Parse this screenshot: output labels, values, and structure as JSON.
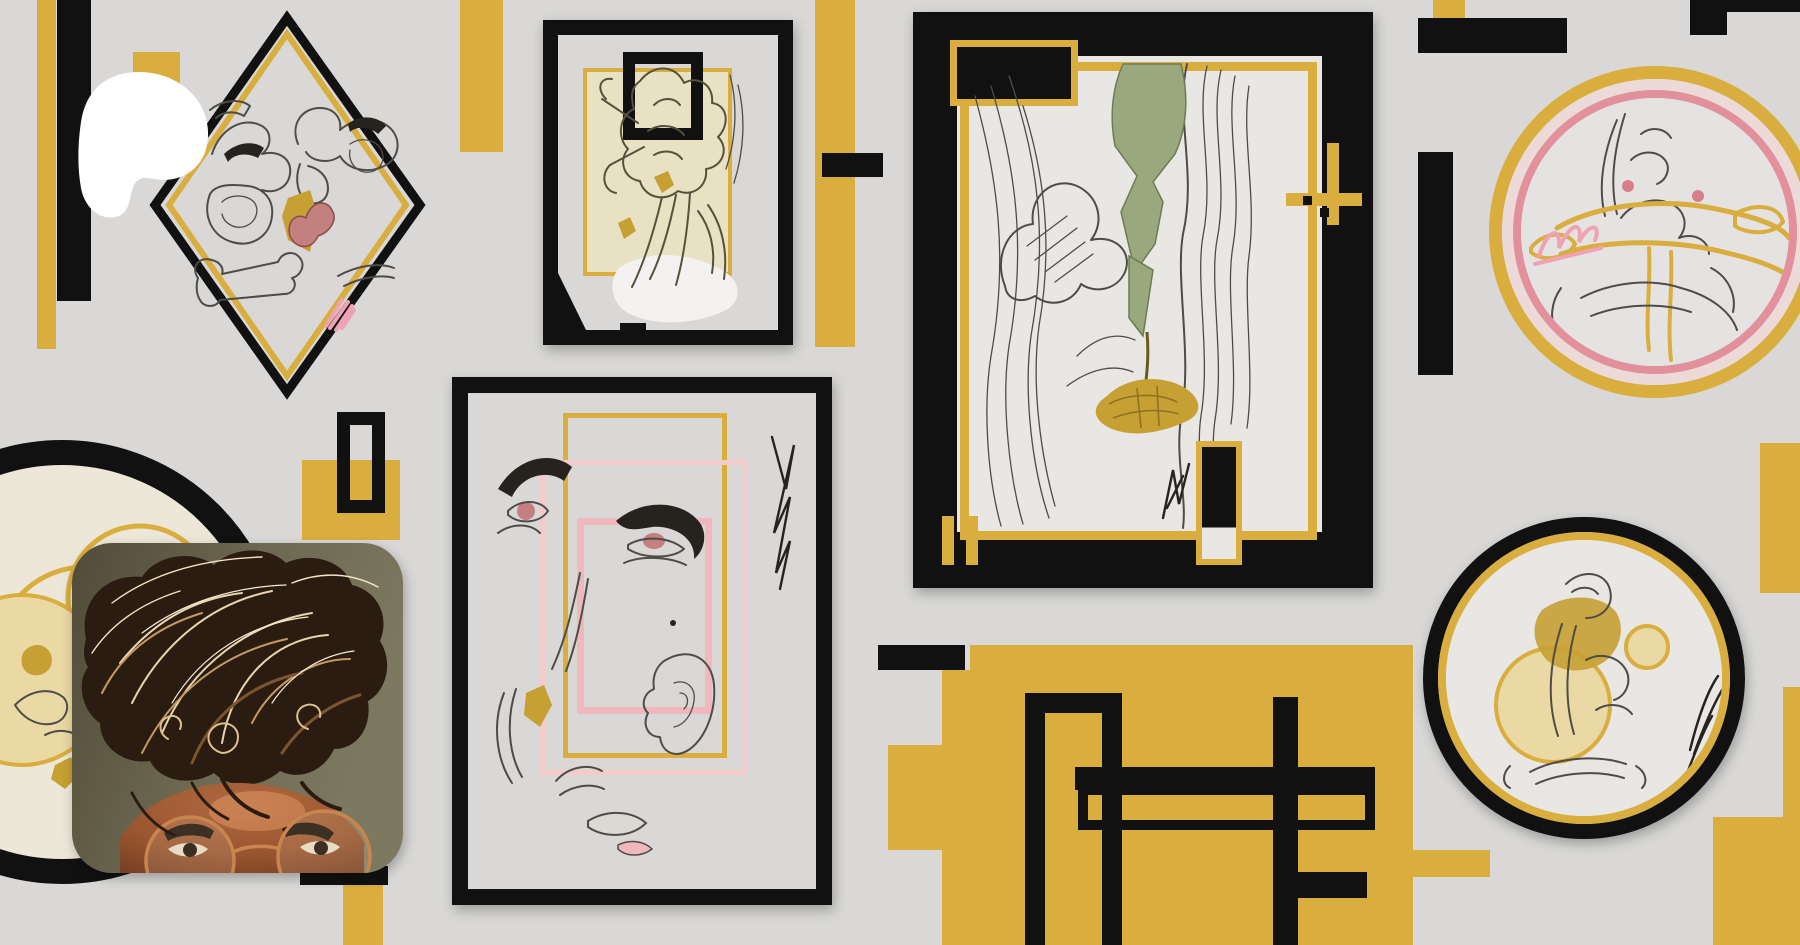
{
  "page": {
    "site": "Patreon",
    "view": "creator-page-header",
    "visible_text": []
  },
  "header": {
    "logo": {
      "name": "patreon-logo",
      "shape": "white-blob",
      "color": "#ffffff"
    },
    "avatar": {
      "shape": "rounded-square",
      "alt": "selfie of a person with sunlit curly brown hair and round wire glasses",
      "corner_radius_px": 40
    },
    "banner": {
      "alt": "abstract collage banner: framed pencil sketches with black and gold geometric blocks on gray"
    }
  },
  "palette": {
    "bg": "#d9d8d6",
    "yellow": "#d9ae3e",
    "black": "#111111",
    "cream": "#ece7d8",
    "beige": "#e8e1c4",
    "sage": "#9aa87e",
    "gold": "#c6a033",
    "lip": "#c47f7f",
    "ink": "#4e4c48",
    "inkDark": "#26231f",
    "white": "#ffffff",
    "pinkRingLight": "#ecdad8",
    "pinkRing": "#e2909b",
    "pinkRectLight": "#f3cbca",
    "pinkRect": "#f0b7bc",
    "pinkSig": "#efa2b2",
    "interiorC": "#e9e7e3",
    "interiorBR": "#e9e7e3",
    "interiorTR": "#e5e3e1",
    "skin": "#a55c38",
    "wall": "#6e6952"
  },
  "banner": {
    "blocks": [
      {
        "n": "left-yellow-bar",
        "x": 37,
        "y": 0,
        "w": 19,
        "h": 349,
        "c": "yellow"
      },
      {
        "n": "left-black-bar",
        "x": 57,
        "y": 0,
        "w": 34,
        "h": 301,
        "c": "black"
      },
      {
        "n": "logo-backdrop-yellow",
        "x": 133,
        "y": 52,
        "w": 47,
        "h": 68,
        "c": "yellow"
      },
      {
        "n": "top-yellow-block",
        "x": 460,
        "y": 0,
        "w": 43,
        "h": 152,
        "c": "yellow"
      },
      {
        "n": "mid-yellow-bar",
        "x": 815,
        "y": 0,
        "w": 40,
        "h": 347,
        "c": "yellow"
      },
      {
        "n": "mid-black-bar",
        "x": 822,
        "y": 153,
        "w": 61,
        "h": 24,
        "c": "black"
      },
      {
        "n": "tr-yellow-tab",
        "x": 1433,
        "y": 0,
        "w": 32,
        "h": 18,
        "c": "yellow"
      },
      {
        "n": "tr-black-bar",
        "x": 1418,
        "y": 18,
        "w": 149,
        "h": 35,
        "c": "black"
      },
      {
        "n": "tr-black-vbar",
        "x": 1418,
        "y": 152,
        "w": 35,
        "h": 223,
        "c": "black"
      },
      {
        "n": "corner-top-bar",
        "x": 1690,
        "y": 0,
        "w": 110,
        "h": 12,
        "c": "black"
      },
      {
        "n": "corner-leg",
        "x": 1690,
        "y": 0,
        "w": 37,
        "h": 35,
        "c": "black"
      },
      {
        "n": "right-yellow-rect",
        "x": 1760,
        "y": 443,
        "w": 40,
        "h": 150,
        "c": "yellow"
      },
      {
        "n": "yellow-square",
        "x": 302,
        "y": 460,
        "w": 98,
        "h": 80,
        "c": "yellow"
      },
      {
        "n": "hollow-rect",
        "x": 337,
        "y": 412,
        "w": 48,
        "h": 101,
        "c": "outline",
        "b": 13
      },
      {
        "n": "avatar-black-bar",
        "x": 300,
        "y": 866,
        "w": 88,
        "h": 19,
        "c": "black"
      },
      {
        "n": "avatar-yellow-bar",
        "x": 343,
        "y": 885,
        "w": 40,
        "h": 60,
        "c": "yellow"
      },
      {
        "n": "bottom-yellow-main",
        "x": 970,
        "y": 645,
        "w": 443,
        "h": 300,
        "c": "yellow"
      },
      {
        "n": "bottom-yellow-step1",
        "x": 942,
        "y": 670,
        "w": 28,
        "h": 275,
        "c": "yellow"
      },
      {
        "n": "bottom-yellow-step2",
        "x": 888,
        "y": 745,
        "w": 54,
        "h": 105,
        "c": "yellow"
      },
      {
        "n": "bottom-yellow-notch",
        "x": 1413,
        "y": 850,
        "w": 77,
        "h": 27,
        "c": "yellow"
      },
      {
        "n": "bottom-black-bar",
        "x": 878,
        "y": 645,
        "w": 87,
        "h": 25,
        "c": "black"
      },
      {
        "n": "door-outline",
        "x": 1025,
        "y": 693,
        "w": 97,
        "h": 252,
        "c": "outline",
        "b": 20,
        "open": "Bottom"
      },
      {
        "n": "grid-hbar",
        "x": 1075,
        "y": 767,
        "w": 300,
        "h": 23,
        "c": "black"
      },
      {
        "n": "grid-box-outline",
        "x": 1078,
        "y": 785,
        "w": 297,
        "h": 45,
        "c": "outline",
        "b": 10
      },
      {
        "n": "grid-vbar",
        "x": 1273,
        "y": 697,
        "w": 25,
        "h": 248,
        "c": "black"
      },
      {
        "n": "grid-stub",
        "x": 1298,
        "y": 872,
        "w": 69,
        "h": 26,
        "c": "black"
      },
      {
        "n": "br-edge-yellow-1",
        "x": 1783,
        "y": 687,
        "w": 17,
        "h": 130,
        "c": "yellow"
      },
      {
        "n": "br-edge-yellow-2",
        "x": 1713,
        "y": 817,
        "w": 87,
        "h": 128,
        "c": "yellow"
      },
      {
        "n": "frameC-cross-h",
        "x": 1286,
        "y": 193,
        "w": 76,
        "h": 13,
        "c": "yellow"
      },
      {
        "n": "frameC-cross-v",
        "x": 1327,
        "y": 143,
        "w": 12,
        "h": 82,
        "c": "yellow"
      },
      {
        "n": "frameC-cross-sq1",
        "x": 1303,
        "y": 196,
        "w": 9,
        "h": 9,
        "c": "black"
      },
      {
        "n": "frameC-cross-sq2",
        "x": 1320,
        "y": 208,
        "w": 9,
        "h": 9,
        "c": "black"
      },
      {
        "n": "frameC-strip1",
        "x": 942,
        "y": 516,
        "w": 12,
        "h": 49,
        "c": "yellow"
      },
      {
        "n": "frameC-strip2",
        "x": 966,
        "y": 516,
        "w": 12,
        "h": 49,
        "c": "yellow"
      }
    ]
  }
}
